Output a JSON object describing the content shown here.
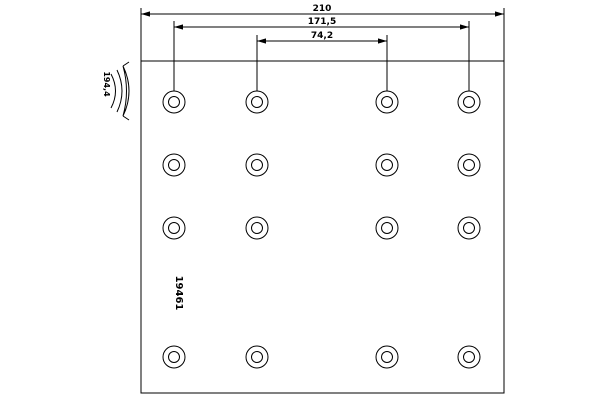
{
  "diagram": {
    "background_color": "#ffffff",
    "line_color": "#000000",
    "plate": {
      "x": 141,
      "y": 61,
      "width": 363,
      "height": 332
    },
    "holes": {
      "columns_x": [
        174,
        257,
        387,
        469
      ],
      "rows_y": [
        102,
        165,
        228,
        357
      ],
      "outer_radius": 11,
      "inner_radius": 5.5,
      "count": 16
    },
    "dimensions": [
      {
        "label": "210",
        "line_y": 14,
        "x1": 141,
        "x2": 504,
        "label_x": 322,
        "label_y": 11,
        "ext": [
          [
            141,
            8,
            61
          ],
          [
            504,
            8,
            61
          ]
        ]
      },
      {
        "label": "171,5",
        "line_y": 27,
        "x1": 174,
        "x2": 469,
        "label_x": 322,
        "label_y": 24,
        "ext": [
          [
            174,
            21,
            91
          ],
          [
            469,
            21,
            91
          ]
        ]
      },
      {
        "label": "74,2",
        "line_y": 41,
        "x1": 257,
        "x2": 387,
        "label_x": 322,
        "label_y": 38,
        "ext": [
          [
            257,
            35,
            91
          ],
          [
            387,
            35,
            91
          ]
        ]
      }
    ],
    "part_number": {
      "text": "19461",
      "x": 176,
      "y": 293,
      "rotation": 90,
      "font_size": 10
    },
    "radius_label": {
      "text": "194,4",
      "x": 104,
      "y": 84,
      "rotation": 90,
      "font_size": 8
    },
    "curvature_symbol": {
      "description": "lining cross-section arc pictogram",
      "x": 110,
      "y": 66
    }
  }
}
